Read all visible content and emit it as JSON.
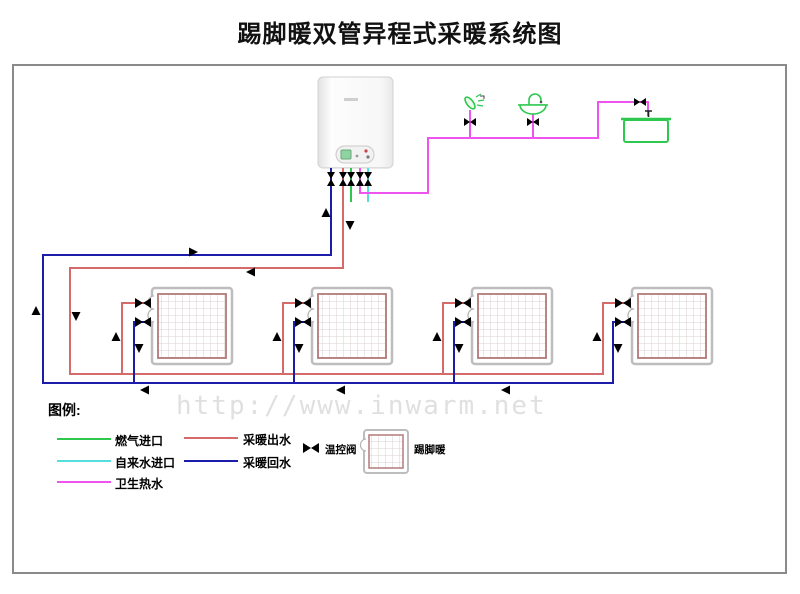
{
  "title": "踢脚暖双管异程式采暖系统图",
  "watermark": "http://www.inwarm.net",
  "legend": {
    "heading": "图例:",
    "lines": [
      {
        "label": "燃气进口",
        "color": "#2ec84e"
      },
      {
        "label": "自来水进口",
        "color": "#55dede"
      },
      {
        "label": "卫生热水",
        "color": "#ee55ee"
      },
      {
        "label": "采暖出水",
        "color": "#d46a6a"
      },
      {
        "label": "采暖回水",
        "color": "#1c1caa"
      }
    ],
    "symbols": [
      {
        "label": "温控阀",
        "icon": "thermostatic-valve-icon"
      },
      {
        "label": "踢脚暖",
        "icon": "baseboard-heater-icon"
      }
    ]
  },
  "colors": {
    "heating_supply": "#d46a6a",
    "heating_return": "#1c1caa",
    "gas_inlet": "#2ec84e",
    "tap_water_inlet": "#55dede",
    "sanitary_hot_water": "#ee55ee",
    "arrow_red": "#ff1a1a",
    "arrow_blue": "#2525cc",
    "valve_black": "#0b0b0b",
    "fixture_valve_dark_red": "#7a1010",
    "fixture_green": "#2ec84e",
    "radiator_inner_border": "#b27a7a",
    "frame_border": "#8a8a8a"
  },
  "icons": {
    "boiler": "wall-hung-boiler-icon",
    "shower": "shower-head-icon",
    "sink": "washbasin-icon",
    "bathtub": "bathtub-icon",
    "radiator": "baseboard-heater-icon",
    "thermostatic_valve": "thermostatic-valve-icon",
    "stop_valve": "stop-valve-icon"
  }
}
